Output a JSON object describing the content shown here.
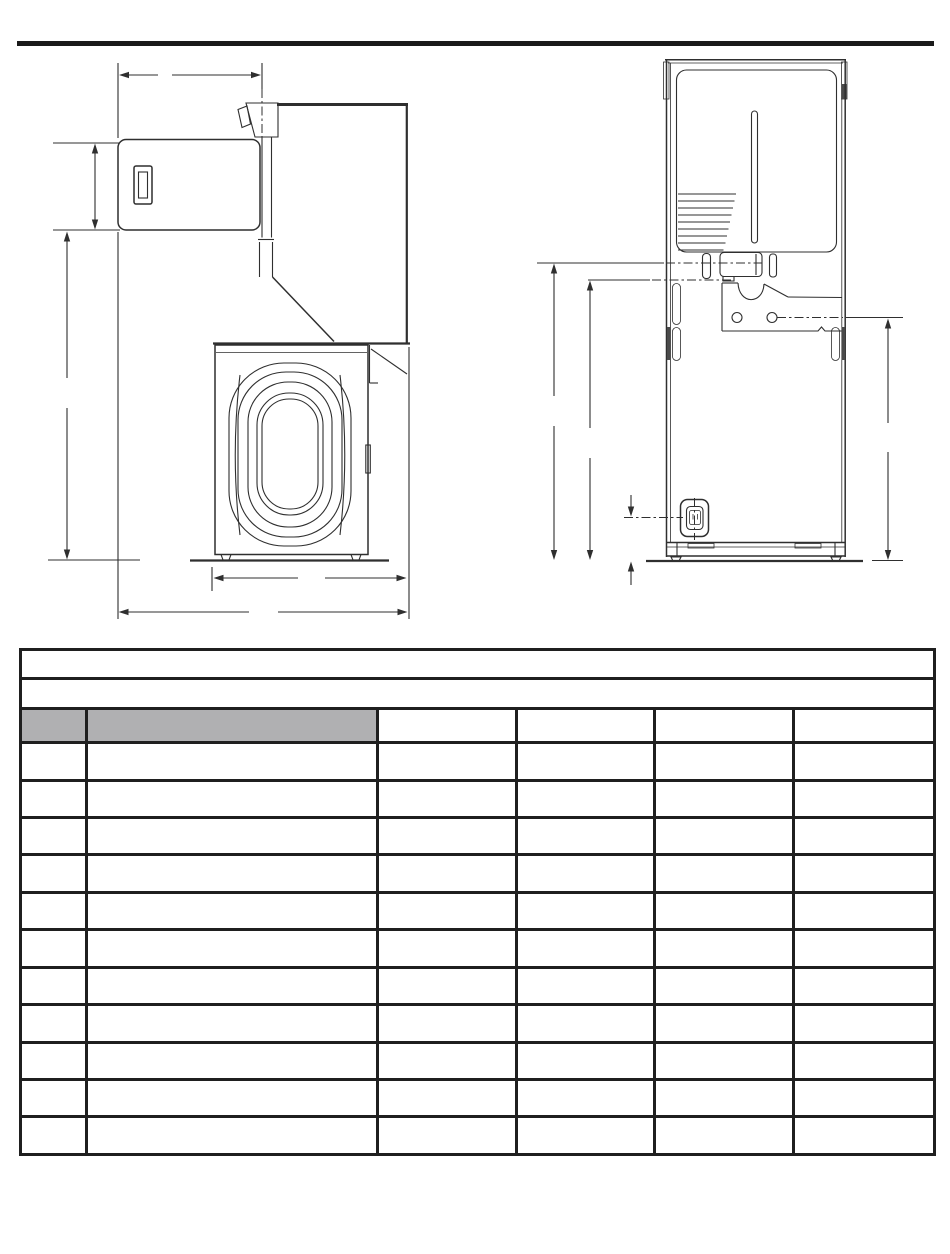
{
  "page": {
    "background": "#ffffff",
    "rule_color": "#1a1a1a",
    "drawing_stroke": "#2f2f2f"
  },
  "drawings": {
    "left_view": "side-view-of-stacked-washer-dryer-with-dimension-lines",
    "right_view": "rear-view-of-stacked-washer-dryer-with-dimension-lines",
    "dimension_labels": []
  },
  "table": {
    "border_color": "#1f1f1f",
    "header_fill": "#b0b0b2",
    "column_count": 6,
    "gray_header_columns": 2,
    "title_rows": [
      "",
      ""
    ],
    "header_row": [
      "",
      "",
      "",
      "",
      "",
      ""
    ],
    "body_rows": [
      [
        "",
        "",
        "",
        "",
        "",
        ""
      ],
      [
        "",
        "",
        "",
        "",
        "",
        ""
      ],
      [
        "",
        "",
        "",
        "",
        "",
        ""
      ],
      [
        "",
        "",
        "",
        "",
        "",
        ""
      ],
      [
        "",
        "",
        "",
        "",
        "",
        ""
      ],
      [
        "",
        "",
        "",
        "",
        "",
        ""
      ],
      [
        "",
        "",
        "",
        "",
        "",
        ""
      ],
      [
        "",
        "",
        "",
        "",
        "",
        ""
      ],
      [
        "",
        "",
        "",
        "",
        "",
        ""
      ],
      [
        "",
        "",
        "",
        "",
        "",
        ""
      ],
      [
        "",
        "",
        "",
        "",
        "",
        ""
      ]
    ]
  }
}
